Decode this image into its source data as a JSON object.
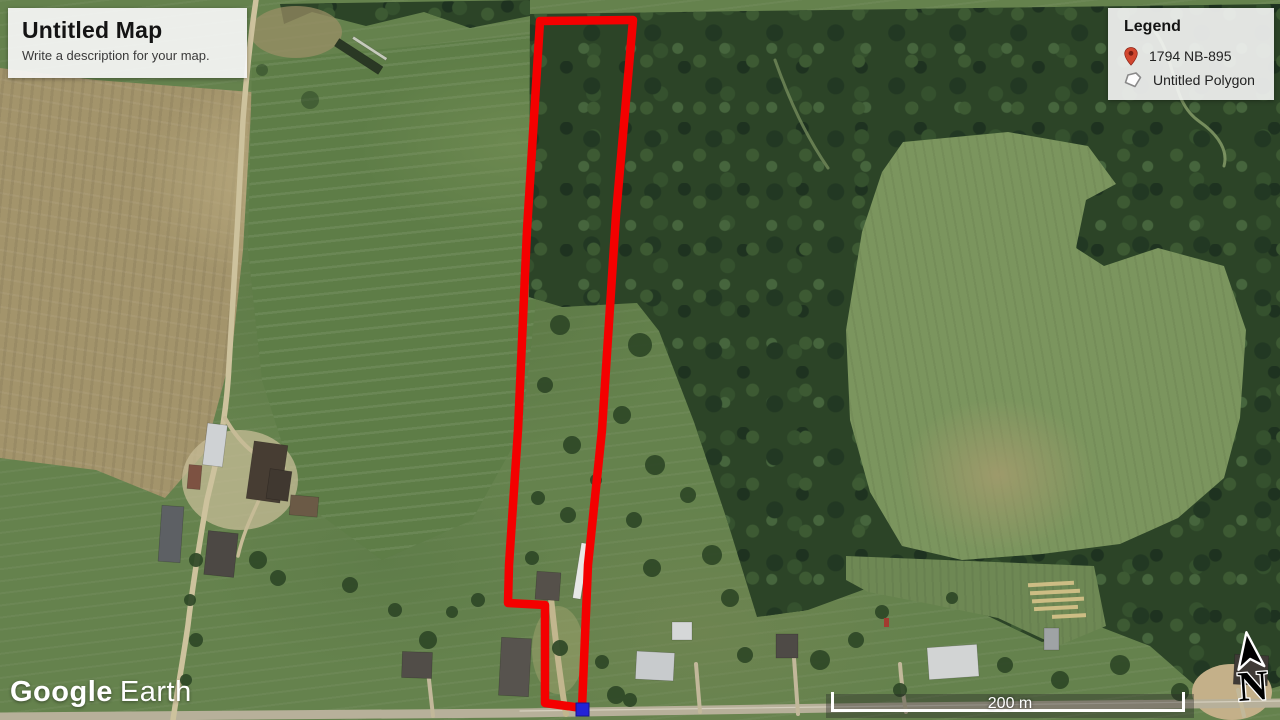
{
  "map": {
    "title_box": {
      "title": "Untitled Map",
      "description": "Write a description for your map."
    },
    "legend": {
      "title": "Legend",
      "items": [
        {
          "icon": "map-pin-icon",
          "label": "1794 NB-895"
        },
        {
          "icon": "polygon-icon",
          "label": "Untitled Polygon"
        }
      ]
    },
    "attribution": {
      "brand": "Google",
      "product": "Earth"
    },
    "scale_bar": {
      "label": "200 m"
    },
    "compass": {
      "label": "N"
    },
    "colors": {
      "polygon_stroke": "#f40000",
      "vertex_marker": "#2323d6",
      "pin_red": "#d2472f",
      "overlay_panel": "#f6f6f6"
    }
  }
}
